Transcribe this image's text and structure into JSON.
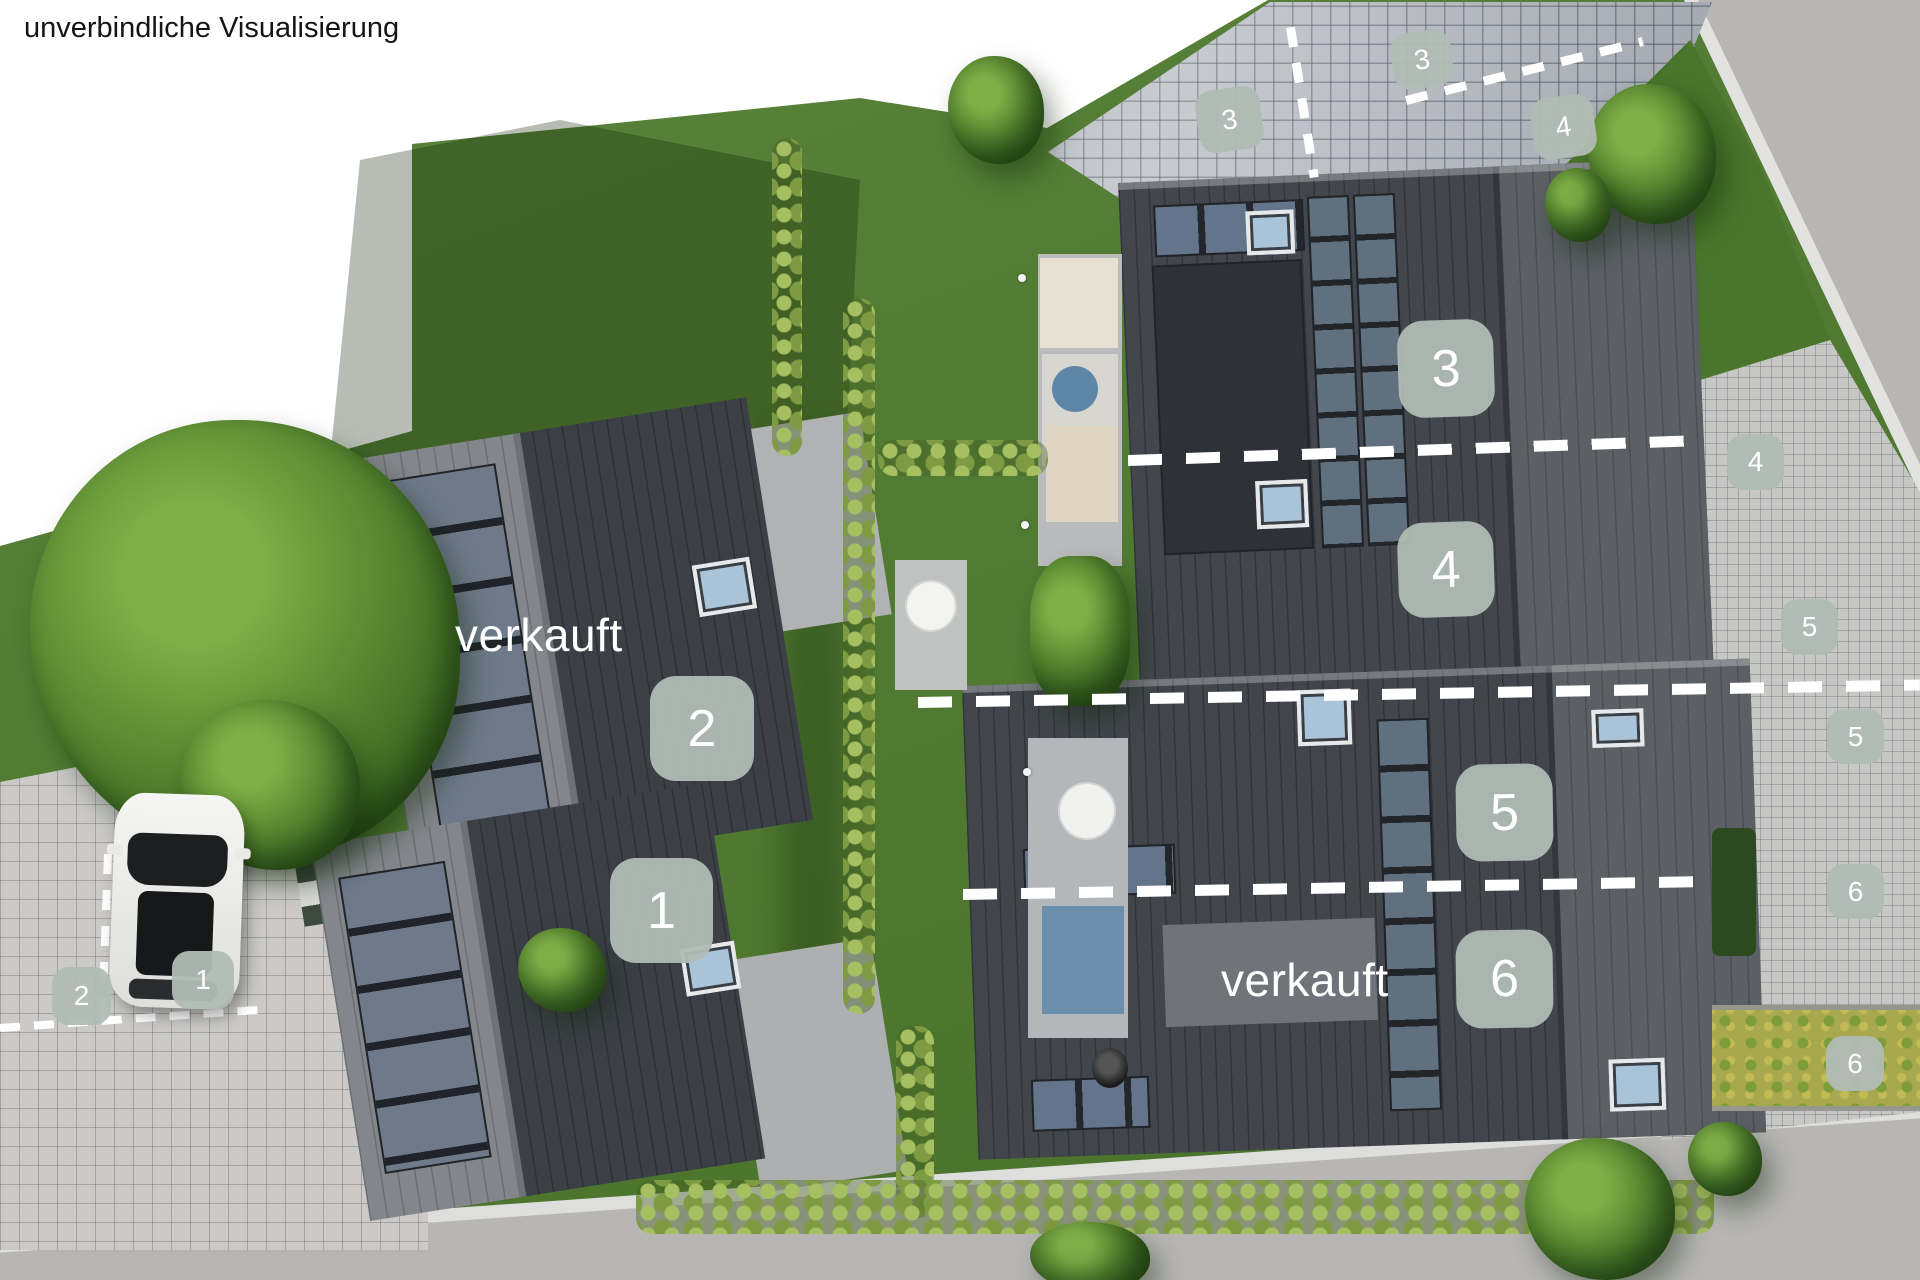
{
  "disclaimer": "unverbindliche Visualisierung",
  "houses": {
    "badges": [
      {
        "unit": "1"
      },
      {
        "unit": "2"
      },
      {
        "unit": "3"
      },
      {
        "unit": "4"
      },
      {
        "unit": "5"
      },
      {
        "unit": "6"
      }
    ],
    "sold_labels": [
      {
        "text": "verkauft",
        "near_unit": "2"
      },
      {
        "text": "verkauft",
        "near_unit": "6"
      }
    ]
  },
  "parking": {
    "badges": [
      {
        "space": "3"
      },
      {
        "space": "3"
      },
      {
        "space": "4"
      },
      {
        "space": "4"
      },
      {
        "space": "5"
      },
      {
        "space": "5"
      },
      {
        "space": "6"
      },
      {
        "space": "6"
      },
      {
        "space": "1"
      },
      {
        "space": "2"
      }
    ]
  },
  "colors": {
    "grass": "#4f7c2e",
    "roof_dark": "#42464c",
    "roof_light_slope": "#5c6065",
    "solar_panel": "#64748a",
    "badge_bg": "#b1bcb5",
    "badge_text": "#ffffff",
    "paving": "#cbcac8",
    "road": "#b7b6b4",
    "marking": "#ffffff"
  }
}
